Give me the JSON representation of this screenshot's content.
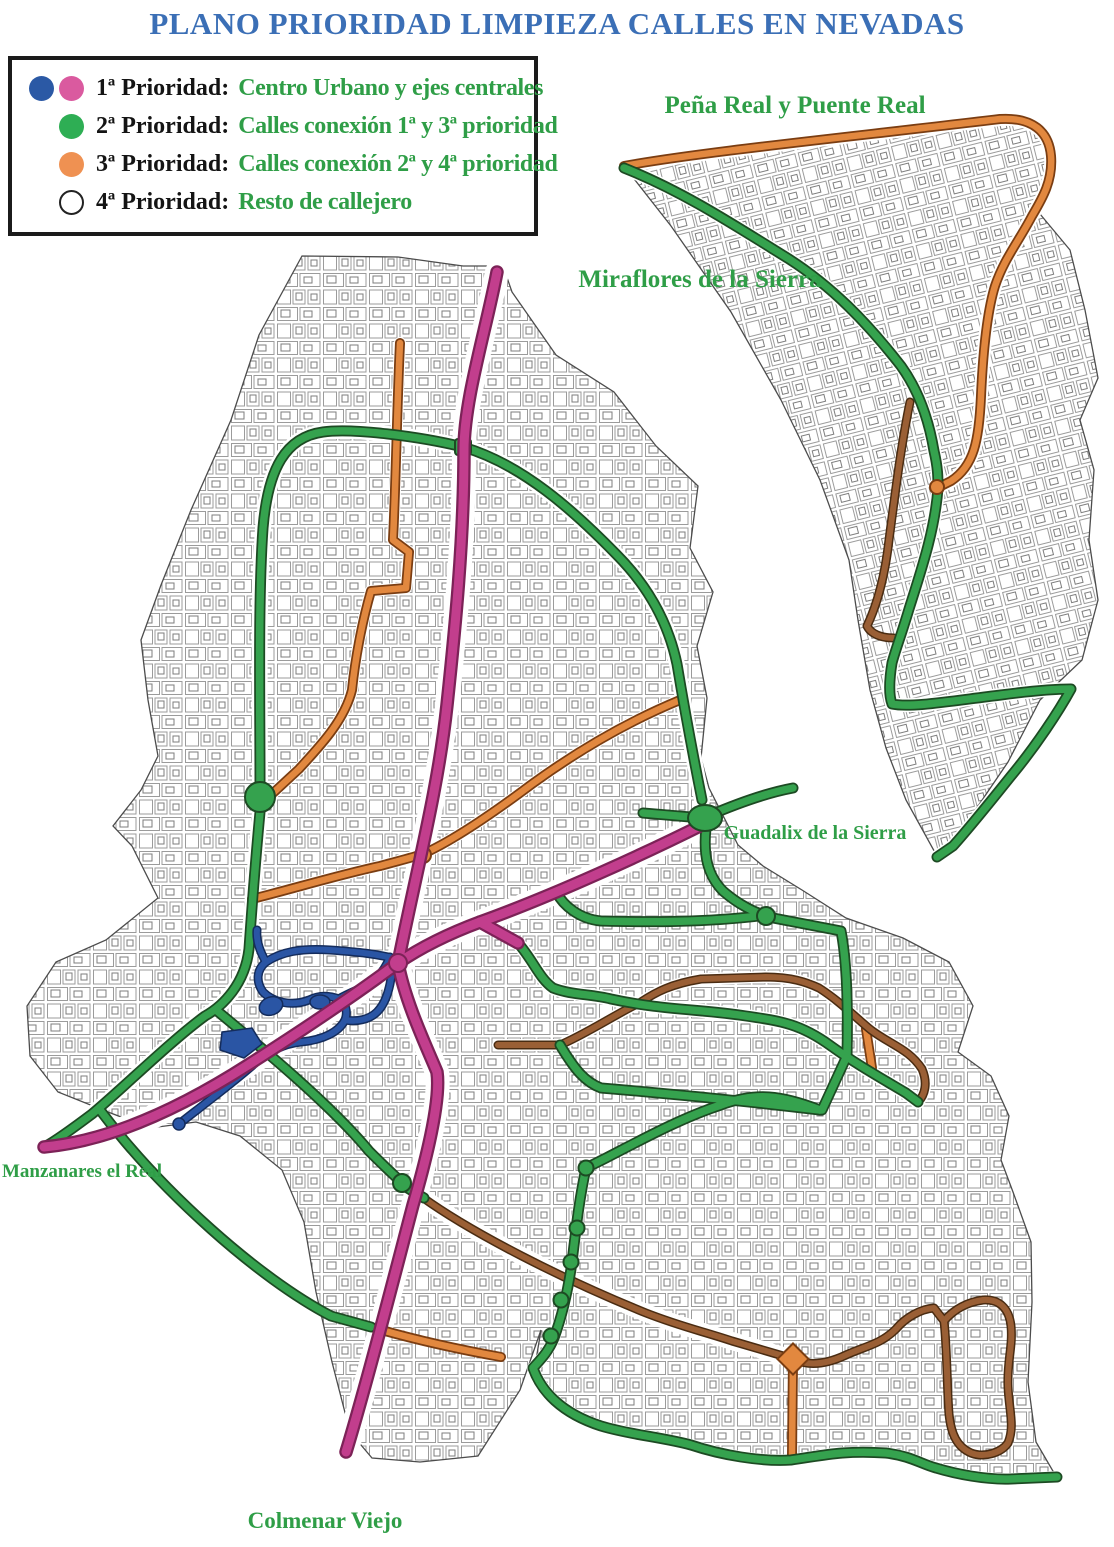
{
  "title": "PLANO PRIORIDAD LIMPIEZA CALLES EN NEVADAS",
  "legend": {
    "items": [
      {
        "term": "1ª Prioridad:",
        "description": "Centro Urbano y ejes centrales",
        "dots": [
          "blue",
          "pink"
        ]
      },
      {
        "term": "2ª Prioridad:",
        "description": "Calles conexión 1ª y 3ª prioridad",
        "dots": [
          "green"
        ]
      },
      {
        "term": "3ª Prioridad:",
        "description": "Calles conexión 2ª y 4ª prioridad",
        "dots": [
          "orange"
        ]
      },
      {
        "term": "4ª Prioridad:",
        "description": "Resto de callejero",
        "dots": [
          "white"
        ]
      }
    ]
  },
  "map": {
    "labels": {
      "penia_real": "Peña Real y Puente Real",
      "miraflores": "Miraflores de la Sierra",
      "guadalix": "Guadalix de la Sierra",
      "manzanares": "Manzanares el Real",
      "colmenar": "Colmenar Viejo"
    }
  },
  "colors": {
    "title": "#3b6fb6",
    "label": "#2f9e47",
    "legend_text": "#141414",
    "priority1_blue": "#2b59a5",
    "priority1_pink": "#da5a9f",
    "priority2_green": "#2eae54",
    "priority3_orange": "#ef9152",
    "priority4_white": "#ffffff",
    "road_pink": "#c23e8d",
    "road_pink_edge": "#7c2257",
    "road_green": "#35a24e",
    "road_green_edge": "#1d4a23",
    "road_orange": "#e2883f",
    "road_orange_edge": "#7a3d12",
    "road_brown": "#9a5f35",
    "road_brown_edge": "#4a2c12",
    "road_blue": "#2a55a4",
    "road_blue_edge": "#142c5c",
    "parcel_line": "#9b9b9b",
    "parcel_detail": "#7d7d7d",
    "boundary": "#4c4c4c"
  }
}
